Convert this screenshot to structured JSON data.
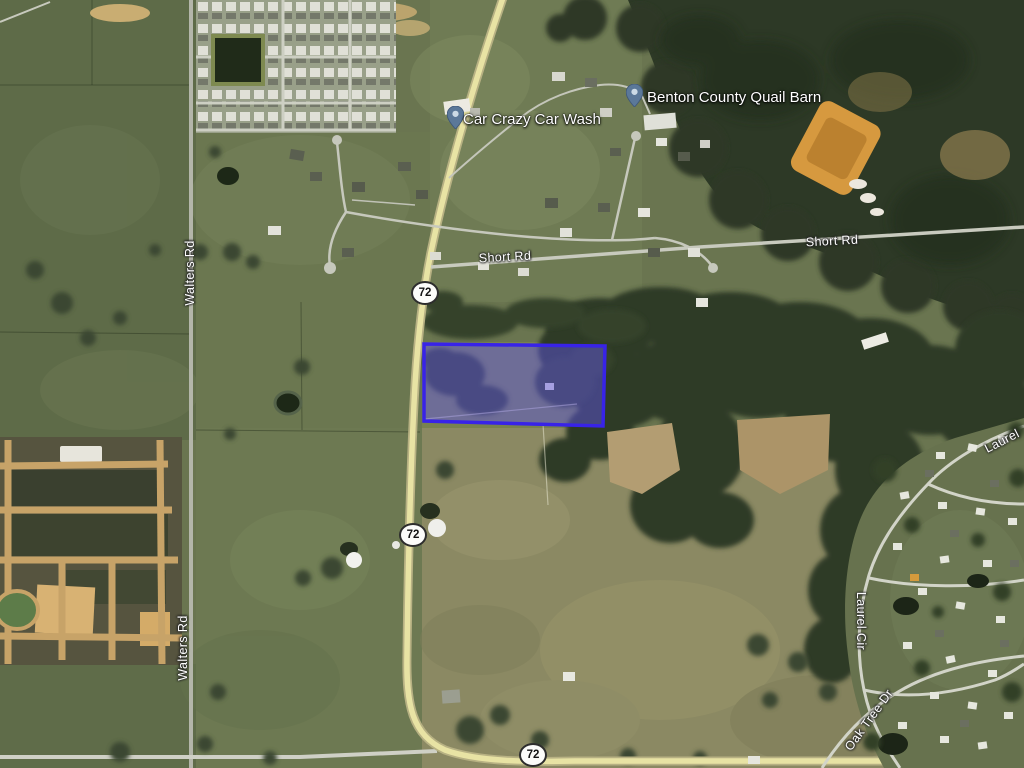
{
  "map": {
    "highway_shield": "72",
    "road_labels": {
      "walters_rd": "Walters Rd",
      "short_rd": "Short Rd",
      "laurel": "Laurel",
      "laurel_cir": "Laurel Cir",
      "oak_tree_dr": "Oak Tree Dr"
    },
    "pois": [
      {
        "name": "Car Crazy Car Wash"
      },
      {
        "name": "Benton County Quail Barn"
      }
    ],
    "parcel": {
      "fill_color": "rgba(97,85,240,0.45)",
      "border_color": "#3823e8"
    },
    "poi_pin_color": "#5b7899"
  }
}
